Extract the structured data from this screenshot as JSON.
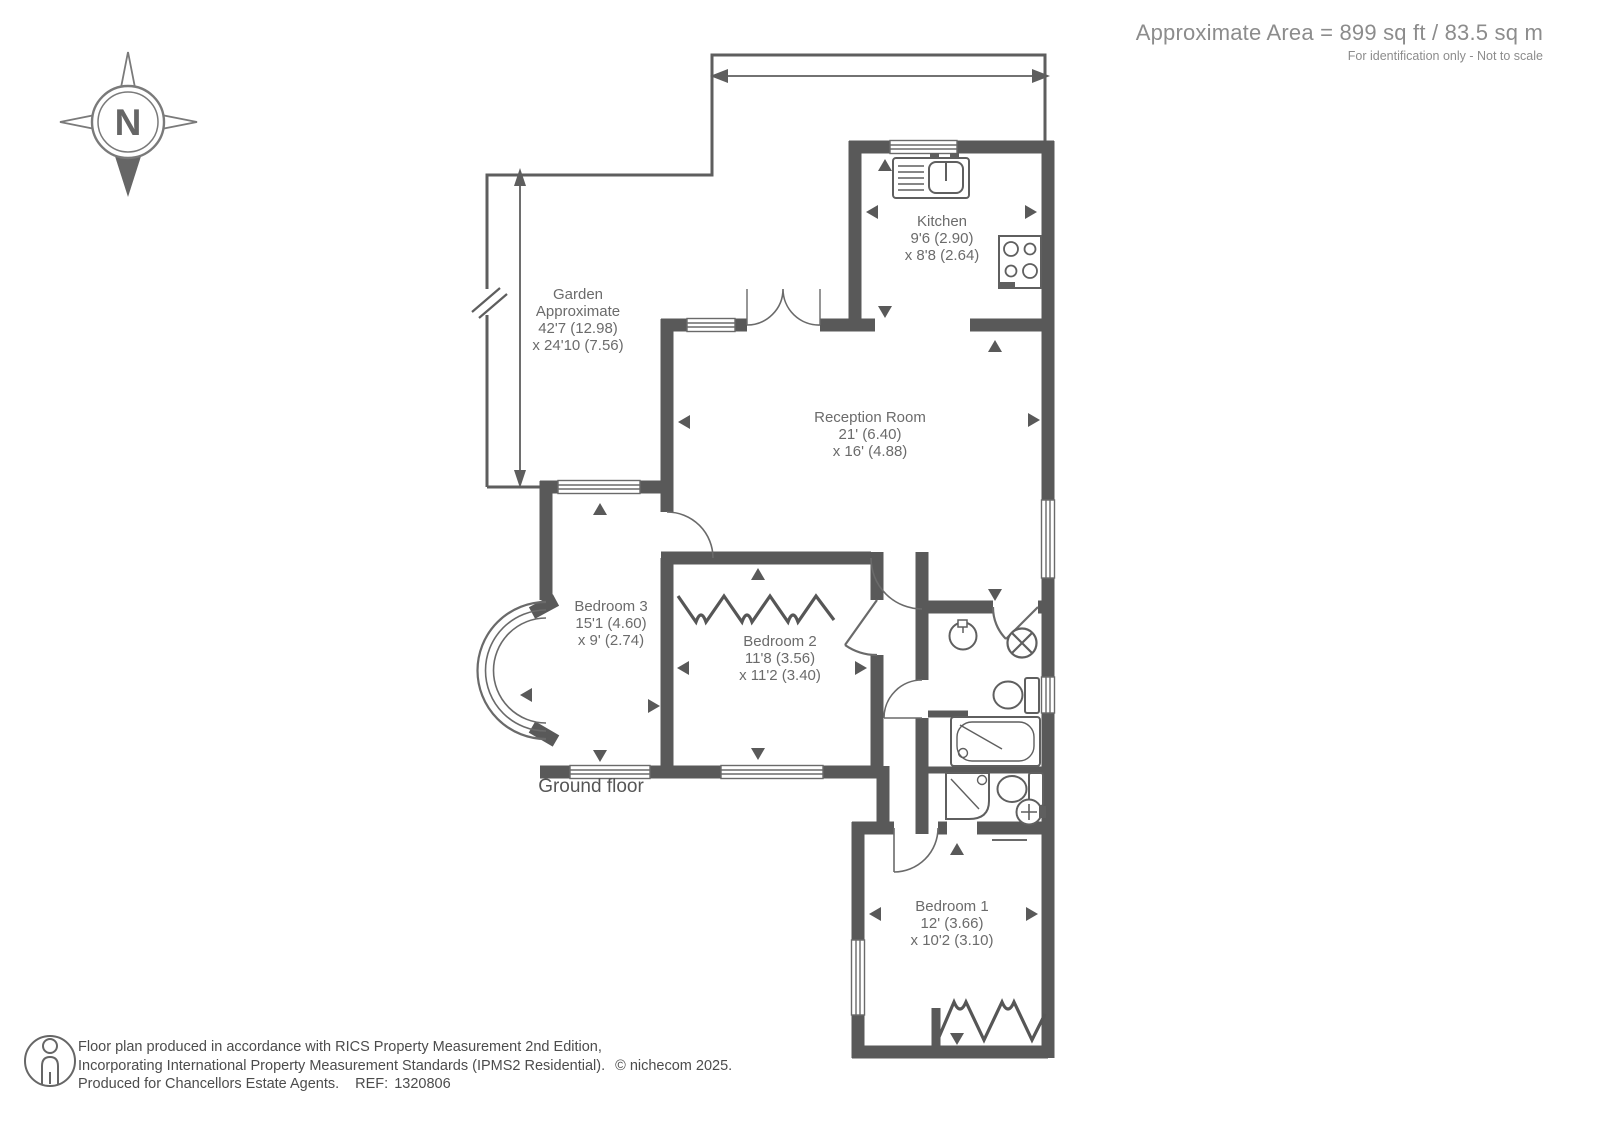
{
  "header": {
    "area_text": "Approximate Area = 899 sq ft / 83.5 sq m",
    "disclaimer": "For identification only - Not to scale"
  },
  "compass": {
    "north_label": "N"
  },
  "floor_label": "Ground floor",
  "rooms": {
    "kitchen": {
      "name": "Kitchen",
      "dim1": "9'6 (2.90)",
      "dim2": "x 8'8 (2.64)"
    },
    "reception": {
      "name": "Reception Room",
      "dim1": "21' (6.40)",
      "dim2": "x 16' (4.88)"
    },
    "garden": {
      "name": "Garden",
      "qualifier": "Approximate",
      "dim1": "42'7 (12.98)",
      "dim2": "x 24'10 (7.56)"
    },
    "bedroom1": {
      "name": "Bedroom 1",
      "dim1": "12' (3.66)",
      "dim2": "x 10'2 (3.10)"
    },
    "bedroom2": {
      "name": "Bedroom 2",
      "dim1": "11'8 (3.56)",
      "dim2": "x 11'2 (3.40)"
    },
    "bedroom3": {
      "name": "Bedroom 3",
      "dim1": "15'1 (4.60)",
      "dim2": "x 9' (2.74)"
    }
  },
  "footer": {
    "line1": "Floor plan produced in accordance with RICS Property Measurement 2nd Edition,",
    "line2": "Incorporating International Property Measurement Standards (IPMS2 Residential).",
    "copyright": "© nichecom 2025.",
    "line3": "Produced for Chancellors Estate Agents.",
    "ref_label": "REF:",
    "ref_number": "1320806"
  },
  "icons": {
    "compass": "compass-rose-north",
    "sink": "kitchen-sink",
    "hob": "four-ring-hob",
    "toilet": "toilet",
    "basin": "wash-basin",
    "bath": "bathtub",
    "shower": "corner-shower",
    "extractor": "circle-x-extractor",
    "wardrobe": "hanging-rail-zigzag",
    "person": "person-scale-figure"
  },
  "colors": {
    "wall": "#595959",
    "line": "#646464",
    "text": "#6b6b6b",
    "header_text": "#8c8c8c",
    "footer_text": "#4c4c4c"
  }
}
